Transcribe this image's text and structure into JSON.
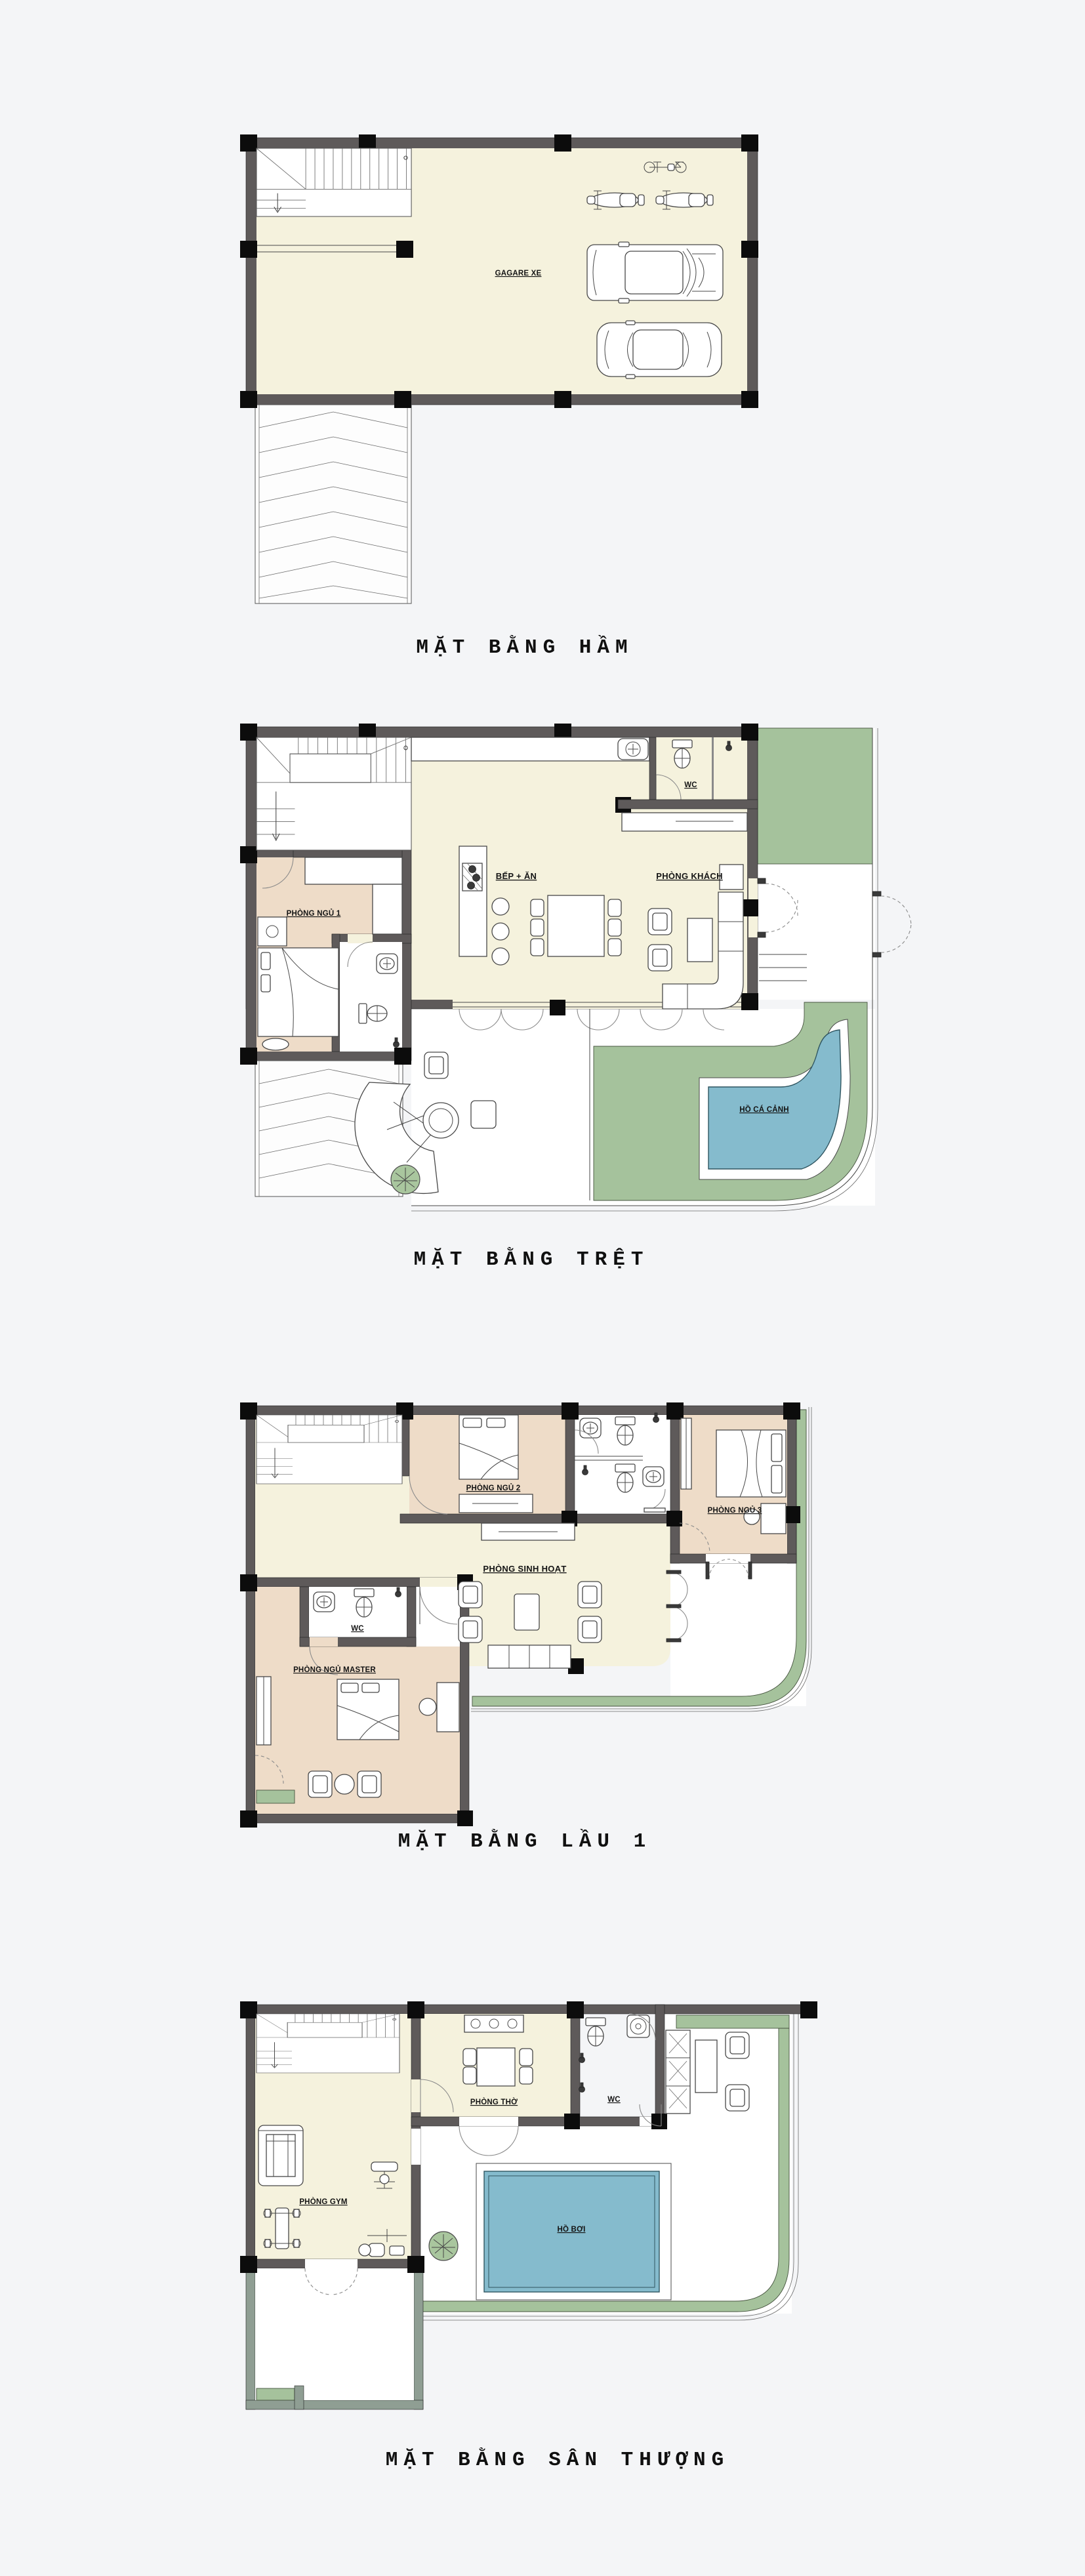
{
  "page": {
    "type": "architectural-floor-plan-sheet",
    "background": "#f4f5f7",
    "colors": {
      "wall": "#5e5a5a",
      "wall_light": "#8f9e93",
      "column": "#0c0c0c",
      "floor_cream": "#f5f2dd",
      "room_tan": "#eedcc8",
      "garden_green": "#a5c29c",
      "water_blue": "#85bbcd",
      "label_text": "#141414"
    }
  },
  "plans": [
    {
      "id": "basement",
      "title": "MẶT BẰNG HẦM",
      "rooms": {
        "garage": "GAGARE XE"
      }
    },
    {
      "id": "ground-floor",
      "title": "MẶT BẰNG TRỆT",
      "rooms": {
        "bedroom1": "PHÒNG NGỦ 1",
        "kitchen": "BẾP + ĂN",
        "living": "PHÒNG KHÁCH",
        "wc": "WC",
        "pond": "HỒ CÁ CẢNH"
      }
    },
    {
      "id": "first-floor",
      "title": "MẶT BẰNG LẦU 1",
      "rooms": {
        "bedroom2": "PHÒNG NGỦ 2",
        "bedroom3": "PHÒNG NGỦ 3",
        "family": "PHÒNG SINH HOẠT",
        "wc": "WC",
        "master": "PHÒNG NGỦ MASTER"
      }
    },
    {
      "id": "roof-terrace",
      "title": "MẶT BẰNG SÂN THƯỢNG",
      "rooms": {
        "worship": "PHÒNG THỜ",
        "wc": "WC",
        "gym": "PHÒNG GYM",
        "pool": "HỒ BƠI"
      }
    }
  ]
}
